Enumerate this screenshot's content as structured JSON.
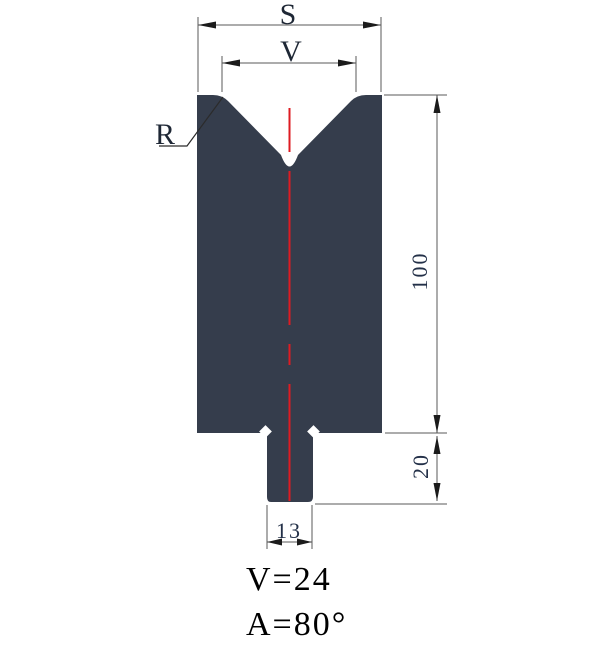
{
  "figure": {
    "type": "technical-drawing",
    "subject": "press-brake V-die cross-section",
    "labels": {
      "overall_width": "S",
      "v_opening": "V",
      "radius": "R",
      "body_height": "100",
      "shank_height": "20",
      "shank_width": "13"
    },
    "captions": {
      "v_value": "V=24",
      "angle_value": "A=80°"
    },
    "colors": {
      "die_fill": "#353D4C",
      "centerline_red": "#DE1B22",
      "dimension_gray": "#5A5A5A",
      "arrow_black": "#1B1B1B",
      "dim_text": "#233048",
      "caption_text": "#000000"
    }
  }
}
